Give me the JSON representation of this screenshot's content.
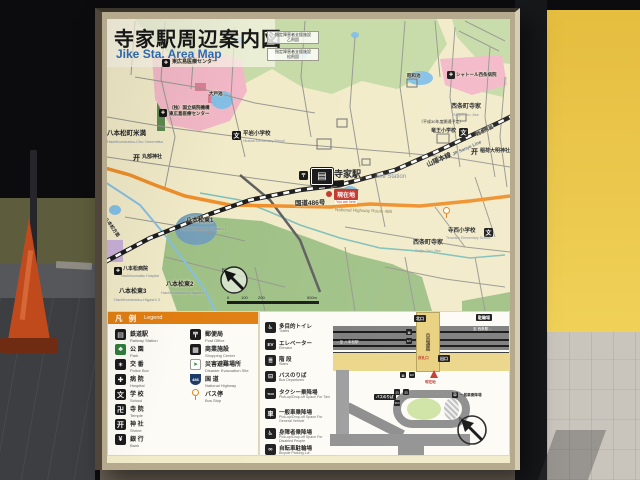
{
  "colors": {
    "map_paper": "#f2ebc9",
    "legend_header_orange": "#e07e12",
    "route_orange": "#ef8f2a",
    "rail_black": "#1c1c1c",
    "water_blue": "#84c0e6",
    "park_green": "#c6dba7",
    "hospital_pink": "#f3b8c7",
    "you_are_here_red": "#c2362b",
    "sign_frame_tan": "#b5a98e",
    "wall_yellow": "#ecc94b",
    "subtitle_blue": "#2e6db4"
  },
  "glyphs": {
    "train": "▤",
    "hospital": "✚",
    "school": "文",
    "shrine": "开",
    "post": "〒"
  },
  "sign": {
    "title_jp": "寺家駅周辺案内図",
    "title_en": "Jike Sta. Area Map",
    "map": {
      "station": {
        "jp": "寺家駅",
        "en": "Jike Station"
      },
      "you_are_here": {
        "jp": "現在地",
        "en": "You are here"
      },
      "rail_line": {
        "jp": "山陽本線",
        "en": "JR Sanyo Line"
      },
      "route486": {
        "jp": "国道486号",
        "en": "National Highway Route 486"
      },
      "directions": {
        "hachihonmatsu": "八本松方面",
        "saijo": "西条方面"
      },
      "areas": [
        {
          "jp": "八本松町米満",
          "en": "Hachihonmatsu-Cho Yonemitsu"
        },
        {
          "jp": "八本松東1",
          "en": "Hachihonmatsu-Higashi 1"
        },
        {
          "jp": "八本松東2",
          "en": "Hachihonmatsu-Higashi 2"
        },
        {
          "jp": "八本松東3",
          "en": "Hachihonmatsu-Higashi 3"
        },
        {
          "jp": "西条町寺家",
          "en": "Saijo-Cho Jike"
        },
        {
          "jp": "西条町寺家",
          "en": "Saijo-Cho Jike"
        }
      ],
      "ponds": [
        {
          "jp": "大戸池"
        },
        {
          "jp": "昭和池"
        }
      ],
      "pois": [
        {
          "jp": "東広島医療センター"
        },
        {
          "jp": "（独）国立病院機構",
          "jp2": "東広島医療センター"
        },
        {
          "jp": "シャトール西条病院"
        },
        {
          "jp": "八本松病院",
          "en": "Hachihonmatsu Hospital"
        },
        {
          "jp": "平岩小学校",
          "en": "Hiraiwa Elementary School"
        },
        {
          "jp": "竜王小学校"
        },
        {
          "jp": "寺西小学校",
          "en": "Teranishi Elementary School"
        },
        {
          "jp": "丸部神社"
        },
        {
          "jp": "稲荷大明神社"
        }
      ],
      "notes": [
        {
          "line1": "指定障害者支援施設",
          "line2": "乙飛園"
        },
        {
          "line1": "指定障害者支援施設",
          "line2": "松飛園"
        },
        {
          "line1": "（平成30年度開通予定）"
        }
      ],
      "scale_ticks": [
        "0",
        "100",
        "200",
        "500m"
      ]
    },
    "legend": {
      "header_jp": "凡 例",
      "header_en": "Legend",
      "col1": [
        {
          "jp": "鉄道駅",
          "en": "Railway Station",
          "glyph": "▤"
        },
        {
          "jp": "公 園",
          "en": "Park",
          "glyph": "♣"
        },
        {
          "jp": "交 番",
          "en": "Police Box",
          "glyph": "✶"
        },
        {
          "jp": "病 院",
          "en": "Hospital",
          "glyph": "✚"
        },
        {
          "jp": "学 校",
          "en": "School",
          "glyph": "文"
        },
        {
          "jp": "寺 院",
          "en": "Temple",
          "glyph": "卍"
        },
        {
          "jp": "神 社",
          "en": "Shrine",
          "glyph": "开"
        },
        {
          "jp": "銀 行",
          "en": "Bank",
          "glyph": "¥"
        }
      ],
      "col2": [
        {
          "jp": "郵便局",
          "en": "Post Office",
          "glyph": "〒"
        },
        {
          "jp": "商業施設",
          "en": "Shopping Center",
          "glyph": "▦"
        },
        {
          "jp": "災害避難場所",
          "en": "Disaster Evacuation Site",
          "glyph": "➤"
        },
        {
          "jp": "国 道",
          "en": "National Highway",
          "glyph": "486"
        },
        {
          "jp": "バス停",
          "en": "Bus Stop",
          "glyph": ""
        }
      ]
    },
    "station_legend": [
      {
        "jp": "多目的トイレ",
        "en": "Toilets",
        "glyph": "♿"
      },
      {
        "jp": "エレベーター",
        "en": "Elevator",
        "glyph": "EV"
      },
      {
        "jp": "階 段",
        "en": "Stairs",
        "glyph": "≣"
      },
      {
        "jp": "バスのりば",
        "en": "Bus Departures",
        "glyph": "⊟"
      },
      {
        "jp": "タクシー乗降場",
        "en": "Pick-up/Drop-off Space For Taxi",
        "glyph": "TAXI"
      },
      {
        "jp": "一般車乗降場",
        "en": "Pick-up/Drop-off Space For General Vehicle",
        "glyph": "車"
      },
      {
        "jp": "身障者乗降場",
        "en": "Pick-up/Drop-off Space For Disabled People",
        "glyph": "♿"
      },
      {
        "jp": "自転車駐輪場",
        "en": "Bicycle Parking Lot",
        "glyph": "∞"
      }
    ],
    "detail_map": {
      "free_passage": "自由通路",
      "north_exit": "北口",
      "bicycle_parking": "駐輪場",
      "ticket_gate": "改札口",
      "exit": "出口",
      "you_are_here": "現在地",
      "bus_boarding": "バスのりば",
      "general_car": "一般車乗降場",
      "to_hachihonmatsu": "←至 八本松駅",
      "to_saijo": "至 西条駅→",
      "taxi": "TAXI"
    }
  }
}
